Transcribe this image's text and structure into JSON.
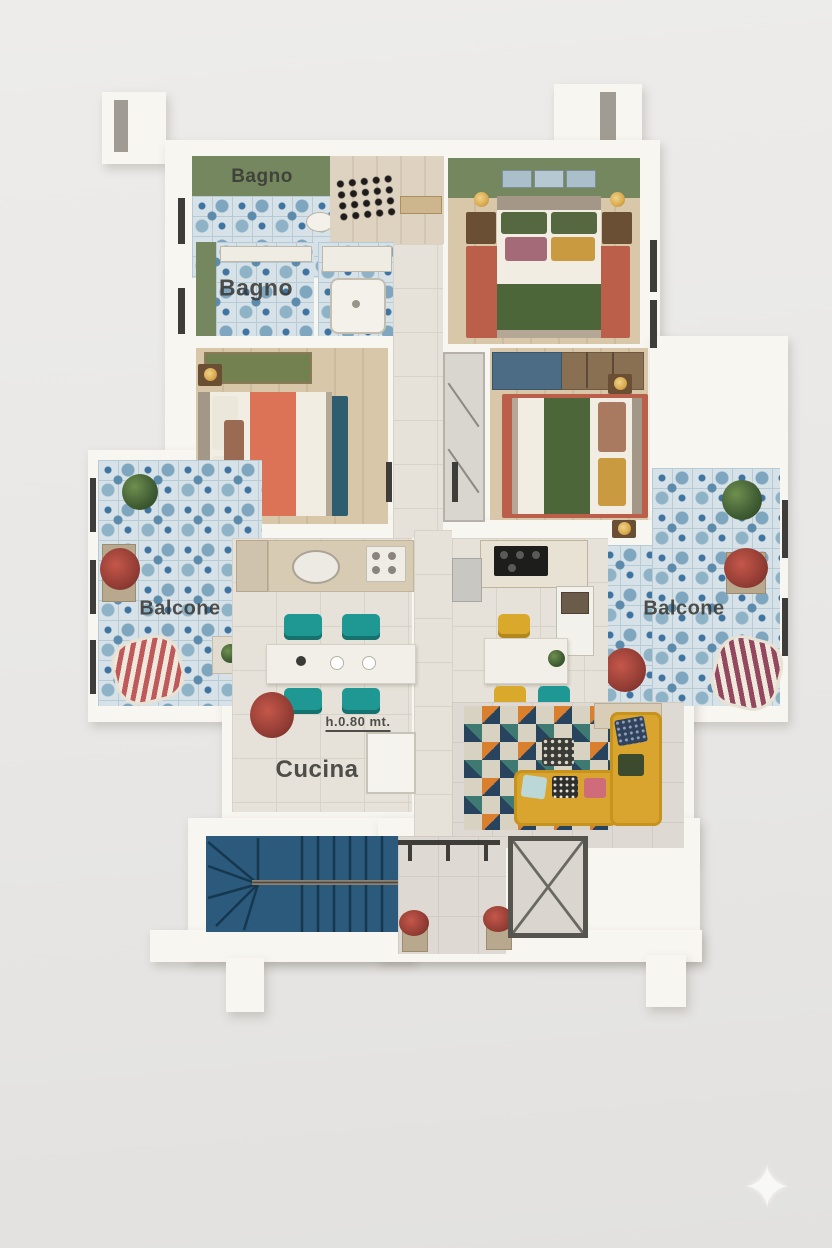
{
  "rooms": [
    {
      "name": "bathroom-top",
      "label": "Bagno"
    },
    {
      "name": "bathroom-middle",
      "label": "Bagno"
    },
    {
      "name": "balcony-left",
      "label": "Balcone"
    },
    {
      "name": "balcony-right",
      "label": "Balcone"
    },
    {
      "name": "kitchen",
      "label": "Cucina",
      "annotation": "h.0.80 mt."
    }
  ],
  "watermark": {
    "glyph": "✦"
  },
  "colors": {
    "background": "#e9e8e6",
    "wall": "#f8f6f1",
    "green_wall": "#74875f",
    "balcony_tile_blue": "#3f74a0",
    "wood_floor": "#d8c7a9",
    "teal_rug": "#2e5d70",
    "terracotta_rug": "#bb5f4b",
    "coral_blanket": "#dd7356",
    "green_blanket": "#4d6639",
    "yellow_sofa": "#d9a52e",
    "teal_chair": "#1f9793",
    "yellow_chair": "#d9a92c",
    "stair_blue": "#2b5a7d",
    "label_text": "#3a3935"
  }
}
